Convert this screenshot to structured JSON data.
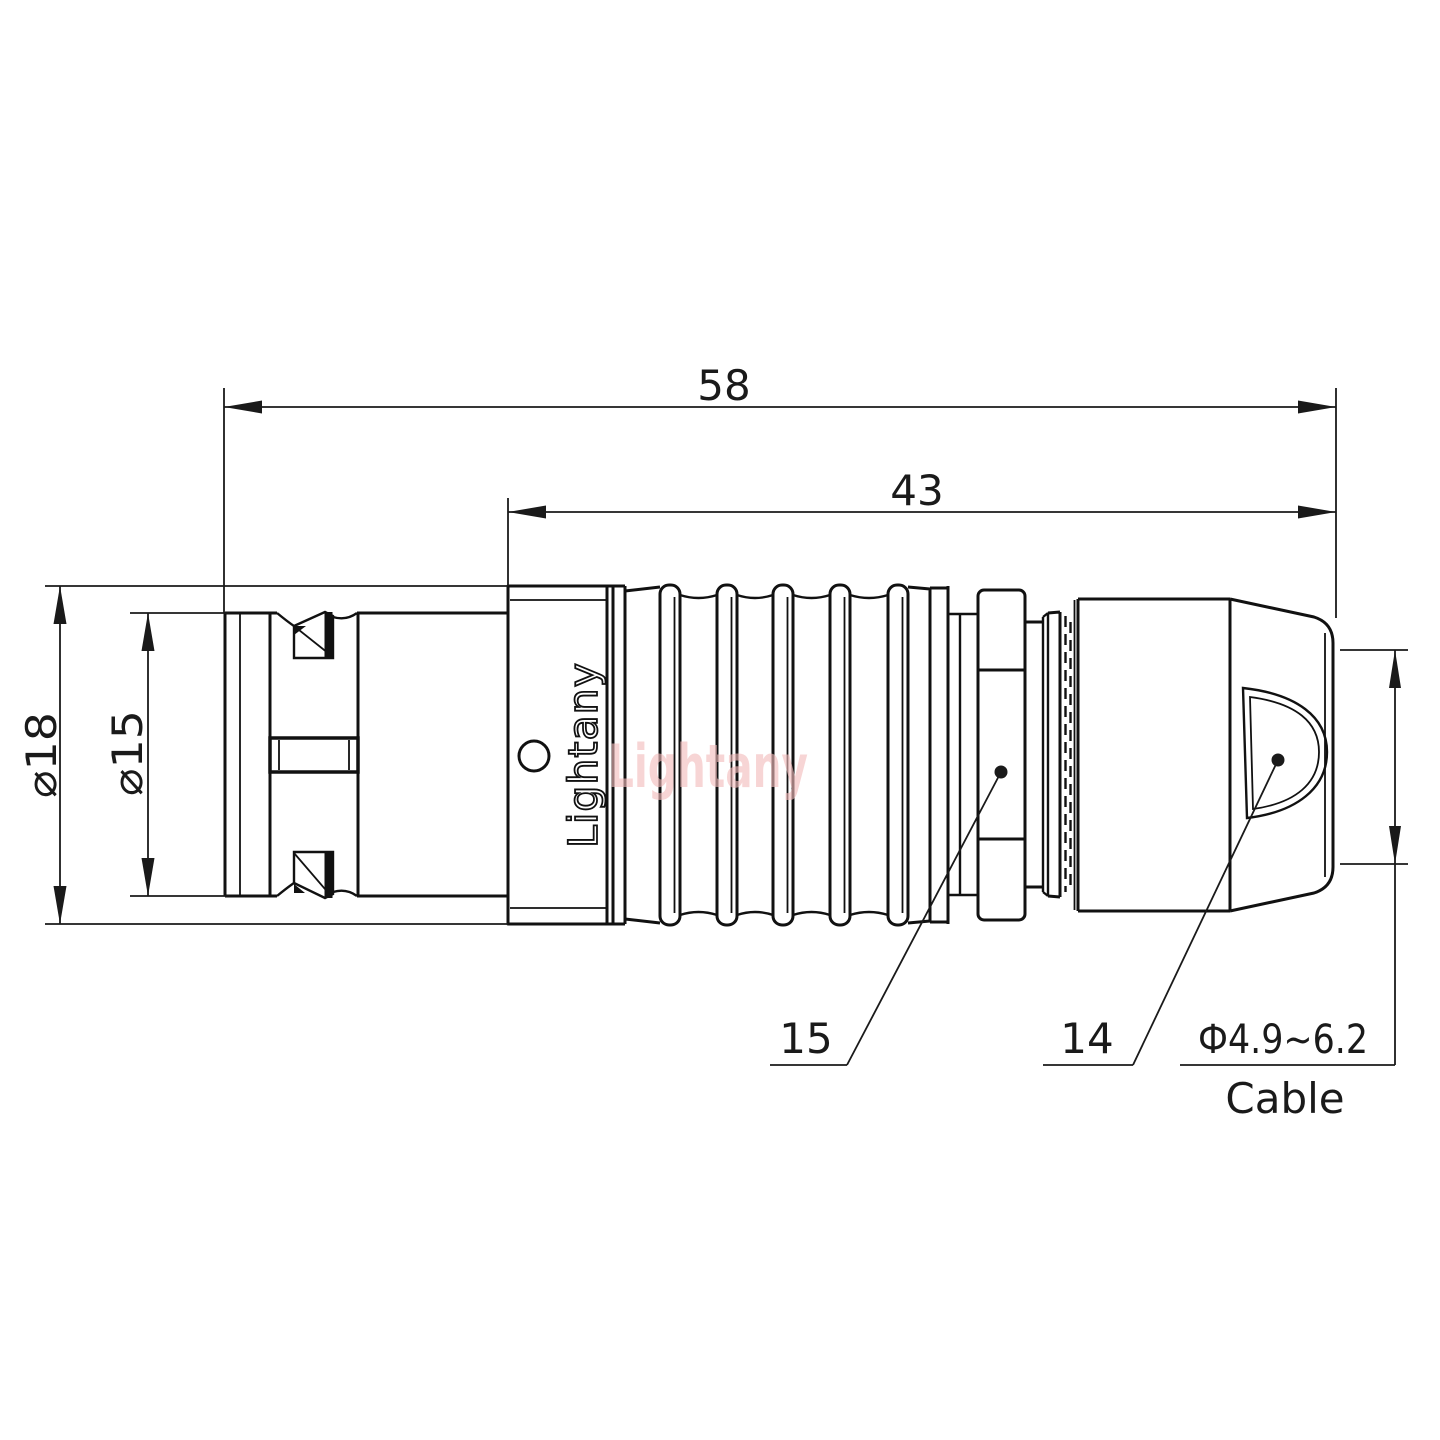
{
  "drawing": {
    "kind": "connector-technical-drawing",
    "brand_marking": "Lightany",
    "watermark_text": "Lightany",
    "colors": {
      "line": "#111111",
      "dimension": "#1a1a1a",
      "watermark_pink": "#f3bcbc",
      "background": "#ffffff"
    },
    "dimensions": {
      "overall_length": "58",
      "body_length": "43",
      "outer_diameter": "⌀18",
      "front_diameter": "⌀15"
    },
    "cable": {
      "range": "Ф4.9~6.2",
      "label": "Cable"
    },
    "callouts": {
      "nut": "15",
      "backshell": "14"
    }
  }
}
